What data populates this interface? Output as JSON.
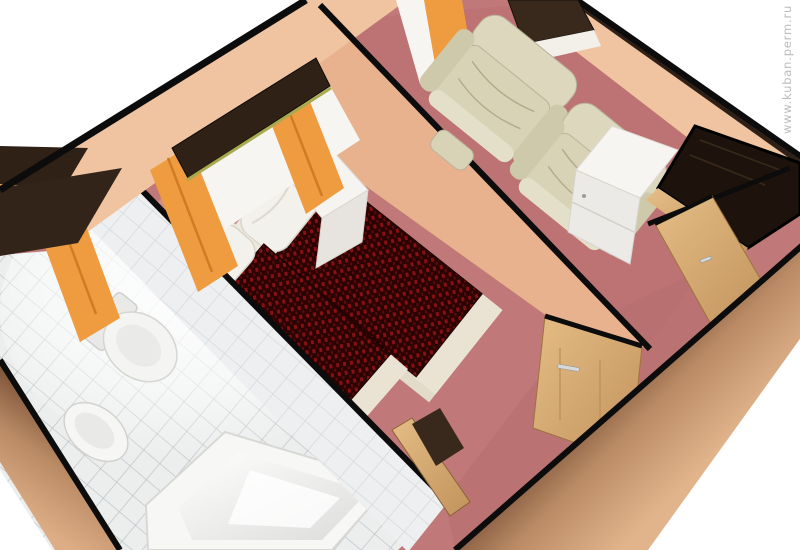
{
  "watermark": {
    "text": "www.kuban.perm.ru"
  },
  "scene": {
    "description": "3D cutaway perspective render of a hotel suite floor plan",
    "rooms": [
      "bathroom",
      "bedroom",
      "sitting-room",
      "entry-hall"
    ],
    "objects": [
      "bathtub",
      "washbasin",
      "toilet",
      "gold-wall-shelf",
      "twin-bed-1",
      "twin-bed-2",
      "pillows",
      "nightstand",
      "window-cornice",
      "orange-curtains",
      "armchair-1",
      "armchair-2",
      "air-conditioner",
      "white-cabinet",
      "dark-wardrobe",
      "wood-doors"
    ]
  },
  "colors": {
    "background": "#ffffff",
    "watermark": "#bcbcbc",
    "outline": "#0c0c0c",
    "wall_peach": "#f0c3a1",
    "wall_peach_dark": "#e9b28e",
    "wall_cut_tan": "#c99671",
    "wall_top_brown": "#33241a",
    "floor_rose": "#c07878",
    "floor_rose_light": "#d4928f",
    "carpet_rose": "#bd7272",
    "hall_rose_dark": "#b66e6e",
    "bed_cover_red": "#871010",
    "bed_cover_red2": "#5f0a0a",
    "bed_cover_dark": "#2b0303",
    "linen_white": "#f3f1ec",
    "sheet_cream": "#efe9dd",
    "bed_base_cream": "#eae3d4",
    "armchair_cream": "#d8d3b6",
    "armchair_light": "#ddd8bd",
    "armchair_shade": "#cfc9ab",
    "curtain_orange": "#ef9b40",
    "cornice_dark": "#2f2115",
    "cornice_olive": "#a8aa4e",
    "window_white": "#f7f5f1",
    "wood_light": "#d7ad76",
    "wood_mid": "#cfa167",
    "tile_light": "#eceeee",
    "tile_grout": "#b3b9bd",
    "fixture_white": "#fafafa",
    "shelf_gold": "#c0a23e",
    "cabinet_white": "#f7f5f2",
    "cabinet_front": "#eceae6",
    "wardrobe_dark": "#1d130c",
    "ac_dark": "#38291c",
    "ac_white": "#f3efe9",
    "handle_silver": "#d6d9db"
  }
}
